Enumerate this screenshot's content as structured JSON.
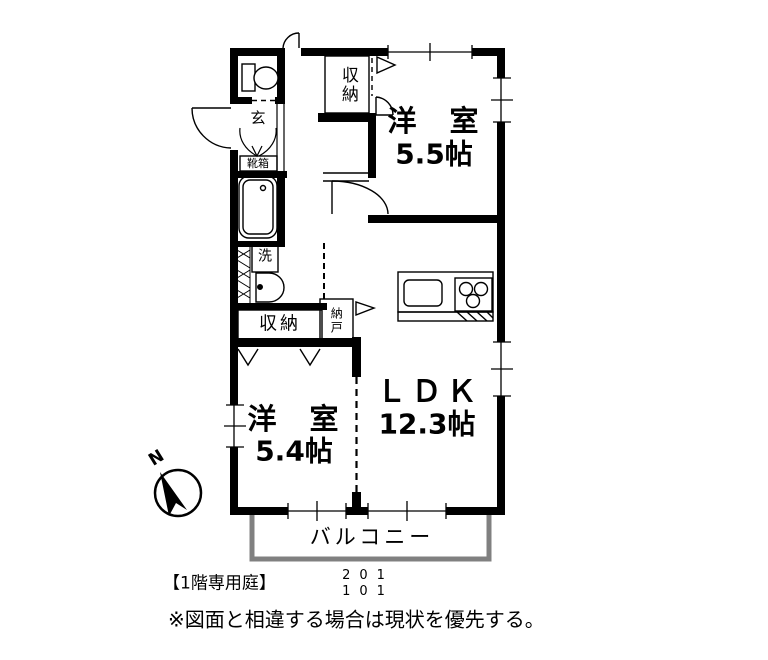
{
  "plan": {
    "rooms": [
      {
        "name": "洋　室",
        "size": "5.5帖"
      },
      {
        "name": "洋　室",
        "size": "5.4帖"
      },
      {
        "name": "ＬＤＫ",
        "size": "12.3帖"
      }
    ],
    "labels": {
      "closet_top": "収納",
      "entrance": "玄",
      "shoebox": "靴箱",
      "washer": "洗",
      "closet_lower": "収納",
      "nando": "納戸",
      "balcony": "バルコニー"
    },
    "compass": {
      "north": "N"
    },
    "footer": {
      "garden_note": "【1階専用庭】",
      "unit_upper": "201",
      "unit_lower": "101",
      "disclaimer": "※図面と相違する場合は現状を優先する。"
    },
    "colors": {
      "line": "#000000",
      "balcony_border": "#808080",
      "background": "#ffffff"
    }
  }
}
